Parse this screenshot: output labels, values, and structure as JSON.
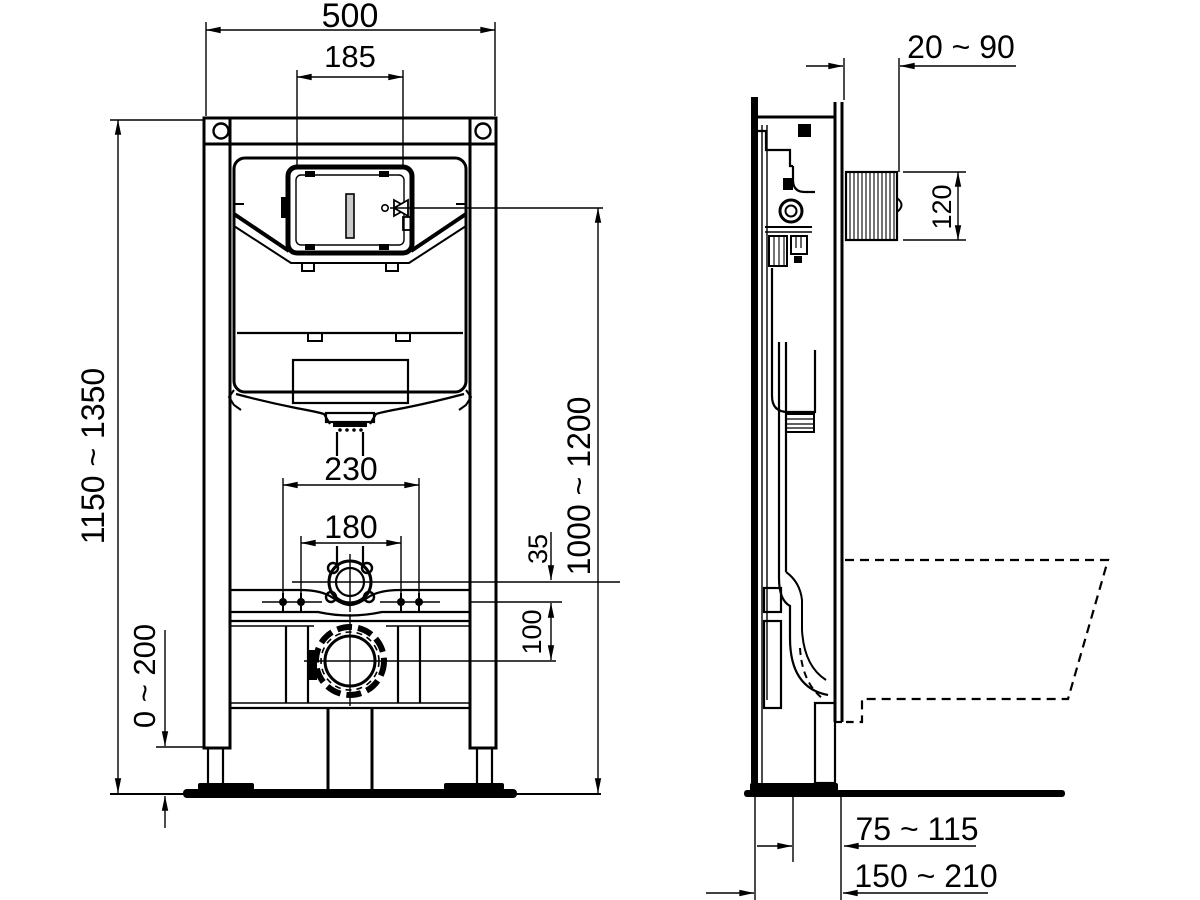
{
  "drawing": {
    "title": "concealed-cistern-wc-frame-installation-dimensions",
    "views": {
      "left": "front-view",
      "right": "side-view"
    },
    "line_color": "#000000",
    "background": "#ffffff"
  },
  "dims": {
    "overall_width": "500",
    "flush_window_width": "185",
    "frame_height_range": "1150 ~ 1350",
    "foot_adjust_range": "0 ~ 200",
    "bolt_spacing_outer": "230",
    "bolt_spacing_inner": "180",
    "inlet_to_rail_offset": "35",
    "rail_to_outlet_offset": "100",
    "flush_plate_height_range": "1000 ~ 1200",
    "wall_finish_range": "20 ~ 90",
    "access_box_height": "120",
    "outlet_to_front_range": "75 ~ 115",
    "frame_depth_range": "150 ~ 210"
  }
}
